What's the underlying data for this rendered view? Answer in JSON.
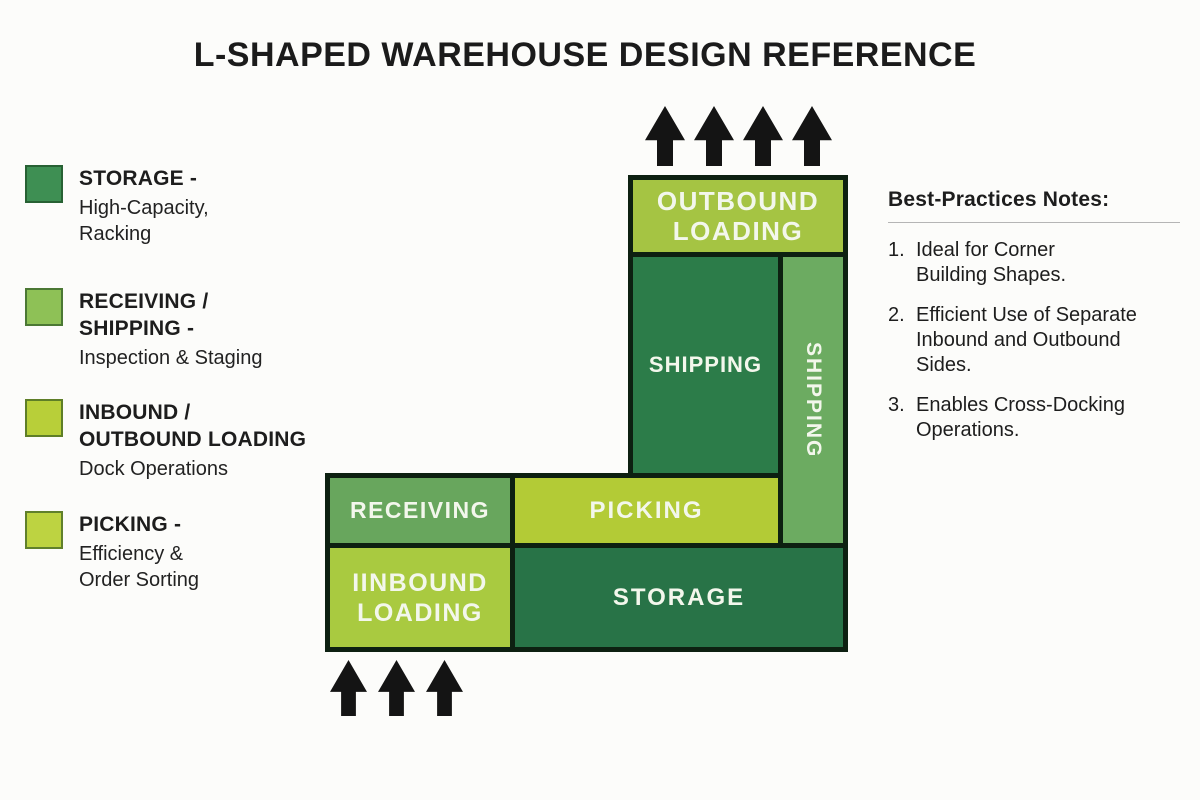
{
  "title": "L-SHAPED WAREHOUSE DESIGN REFERENCE",
  "palette": {
    "dark_green": "#2c7c49",
    "medium_green": "#68a65d",
    "lime_green": "#b3cb36",
    "yellow_green": "#a9ca40",
    "outline_dark": "#0d2011",
    "block_label_text": "#f3f7ec",
    "arrow_black": "#141414"
  },
  "legend": {
    "items": [
      {
        "swatch_color": "#3e8f53",
        "icon": "storage-swatch",
        "title": "STORAGE -",
        "subtitle": "High-Capacity,\nRacking"
      },
      {
        "swatch_color": "#8ec156",
        "icon": "receiving-swatch",
        "title": "RECEIVING /\nSHIPPING -",
        "subtitle": "Inspection & Staging"
      },
      {
        "swatch_color": "#b8cf39",
        "icon": "inbound-swatch",
        "title": "INBOUND /\nOUTBOUND LOADING",
        "subtitle": "Dock Operations"
      },
      {
        "swatch_color": "#bdd341",
        "icon": "picking-swatch",
        "title": "PICKING -",
        "subtitle": "Efficiency &\nOrder Sorting"
      }
    ]
  },
  "diagram": {
    "blocks": {
      "outbound_loading": {
        "label": "OUTBOUND\nLOADING",
        "color": "#a5c443"
      },
      "shipping_main": {
        "label": "SHIPPING",
        "color": "#2c7c49"
      },
      "shipping_side": {
        "label": "SHIPPING",
        "color": "#6cab61"
      },
      "receiving": {
        "label": "RECEIVING",
        "color": "#68a65d"
      },
      "picking": {
        "label": "PICKING",
        "color": "#b3cb36"
      },
      "inbound_loading": {
        "label": "IINBOUND\nLOADING",
        "color": "#a9ca40"
      },
      "storage": {
        "label": "STORAGE",
        "color": "#287347"
      }
    },
    "top_arrow_count": 4,
    "bottom_arrow_count": 3
  },
  "notes": {
    "heading": "Best-Practices Notes:",
    "items": [
      {
        "num": "1.",
        "text": "Ideal for Corner\nBuilding Shapes."
      },
      {
        "num": "2.",
        "text": "Efficient Use of Separate\nInbound and Outbound\nSides."
      },
      {
        "num": "3.",
        "text": "Enables Cross-Docking\nOperations."
      }
    ]
  }
}
